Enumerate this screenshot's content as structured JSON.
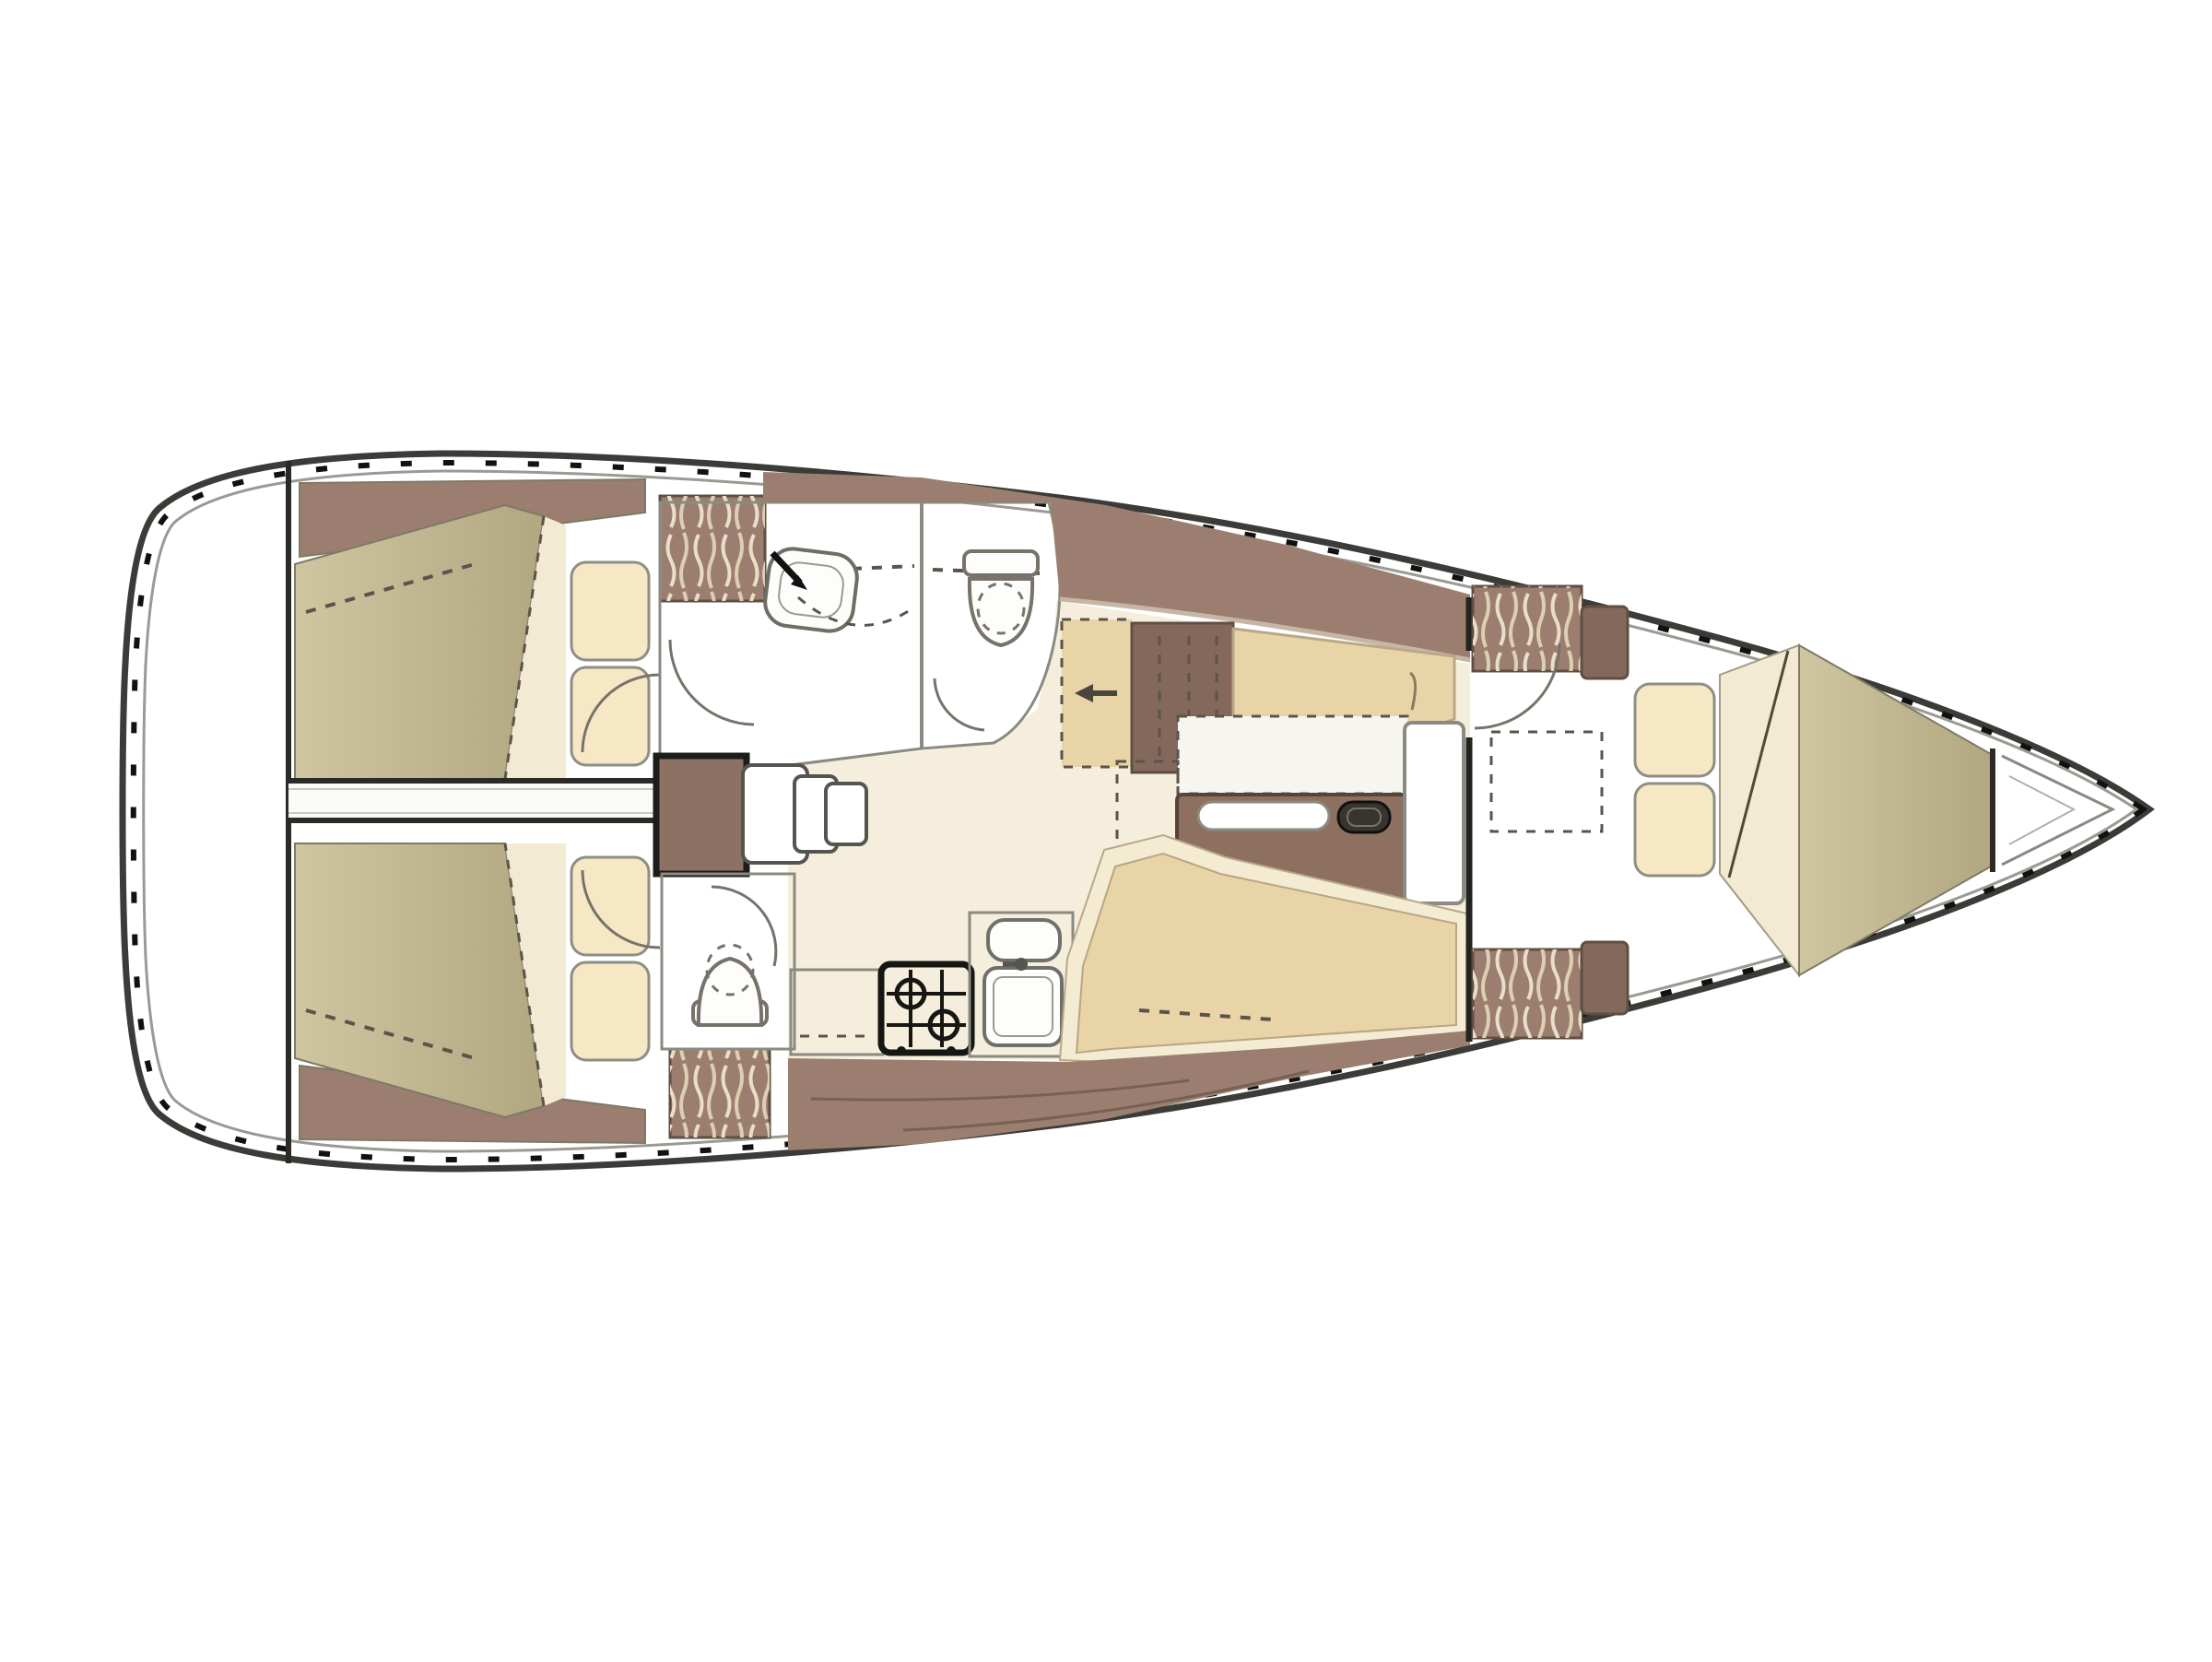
{
  "diagram": {
    "type": "yacht-interior-floorplan",
    "orientation": "bow-right",
    "visible_text": "",
    "rooms_depicted_count": 6
  },
  "colors": {
    "white": "#ffffff",
    "floor": "#f6eedc",
    "corridor": "#fafaf7",
    "wood": "#9b7e6f",
    "wood-dark": "#8d7164",
    "wood-block": "#85685c",
    "table-wood": "#8d7060",
    "khaki-1": "#cfc6a1",
    "khaki-2": "#b1a781",
    "wedge-cream": "#f2ead2",
    "pillow": "#f6e8c4",
    "settee-tan": "#e9d4a8",
    "settee-light": "#f4ebd3",
    "counter-grey": "#e8e8e3",
    "fixture-white": "#fdfdfb",
    "stove-face": "#f0f0ea",
    "stove-line": "#161612",
    "dark-oval": "#38342f",
    "hull-line": "#3b3b37",
    "deck-line": "#9a9a93",
    "toerail": "#111111",
    "wall-grey": "#8a8a82",
    "bulkhead": "#2a2a26",
    "arc-grey": "#77736b",
    "dash-dark": "#5a544a",
    "grain": "#6e5a4e",
    "furn-line": "#7e7a66",
    "hanger-cream": "#e9dfc8"
  }
}
